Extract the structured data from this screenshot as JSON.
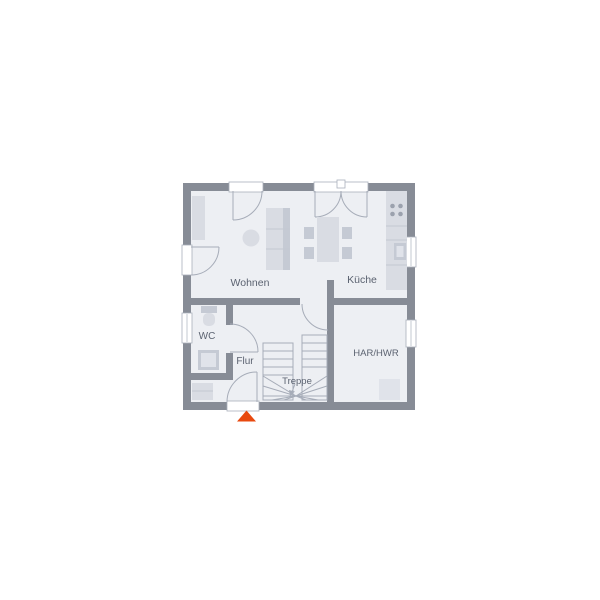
{
  "meta": {
    "type": "architectural-floor-plan",
    "background": "#ffffff",
    "floor_shown": "ground-floor"
  },
  "colors": {
    "wall": "#878c96",
    "floor": "#edeff3",
    "furniture_light": "#d9dce3",
    "furniture_dark": "#c5cad4",
    "outline": "#a6acb8",
    "text": "#5b6270",
    "entrance_marker": "#e8490f"
  },
  "rooms": {
    "wohnen": {
      "label": "Wohnen"
    },
    "kueche": {
      "label": "Küche"
    },
    "wc": {
      "label": "WC"
    },
    "flur": {
      "label": "Flur"
    },
    "treppe": {
      "label": "Treppe"
    },
    "har_hwr": {
      "label": "HAR/HWR"
    }
  },
  "markers": {
    "entrance": {
      "shape": "triangle-up",
      "color": "#e8490f"
    }
  },
  "features": {
    "doors": [
      "terrace-door-top",
      "double-french-door-top",
      "side-door-left",
      "hall-door",
      "wc-door",
      "entrance-door-bottom"
    ],
    "windows": [
      "wc-window-left",
      "kitchen-window-right",
      "har-window-right"
    ],
    "furniture": [
      "sideboard",
      "round-table",
      "sofa",
      "dining-table",
      "chairs",
      "kitchen-counter",
      "stove",
      "kitchen-sink",
      "toilet",
      "wc-sink",
      "wardrobe",
      "appliance",
      "winder-staircase"
    ]
  }
}
